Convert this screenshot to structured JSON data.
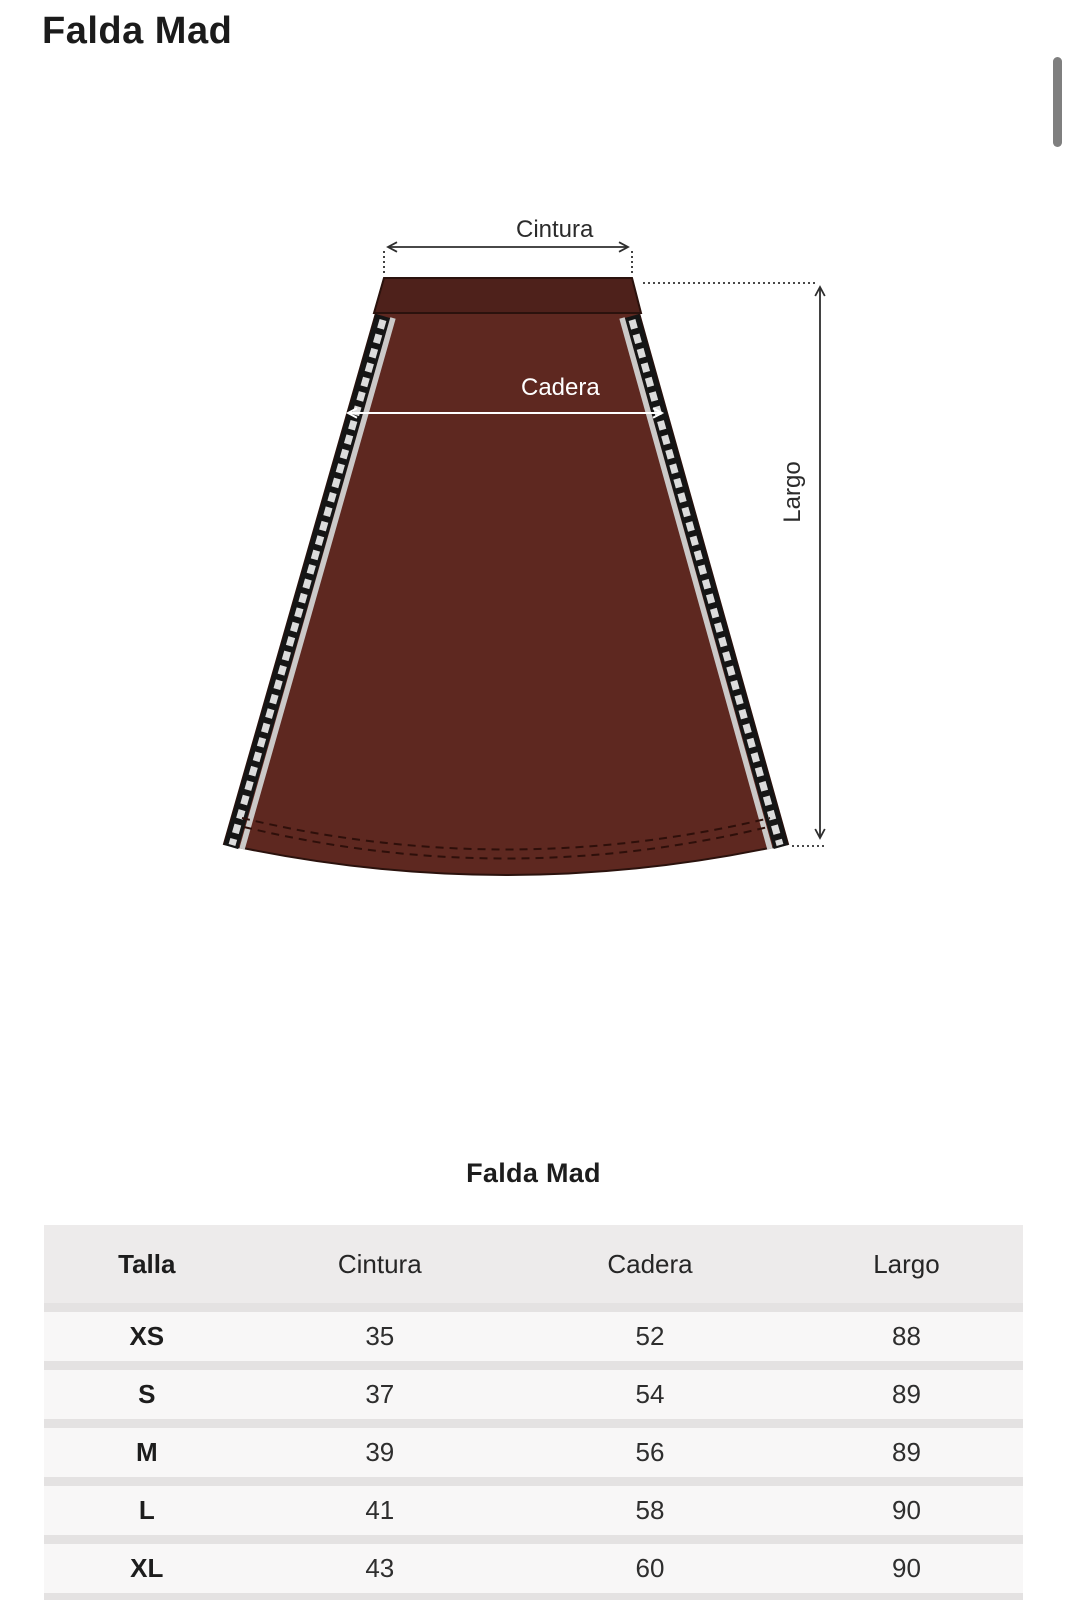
{
  "page": {
    "title": "Falda Mad",
    "background": "#ffffff"
  },
  "scrollbar": {
    "color": "#7f7f7f"
  },
  "diagram": {
    "waist_label": "Cintura",
    "hip_label": "Cadera",
    "length_label": "Largo",
    "colors": {
      "skirt_body": "#5e2820",
      "waistband": "#4e211b",
      "outline": "#2b120d",
      "side_tape": "#151515",
      "tape_stripe": "#cbc9c8",
      "stitch": "#2e0f0a",
      "measure_line": "#2e2e2e",
      "hip_measure_line": "#ffffff"
    }
  },
  "size_table": {
    "title": "Falda Mad",
    "columns": [
      "Talla",
      "Cintura",
      "Cadera",
      "Largo"
    ],
    "rows": [
      [
        "XS",
        "35",
        "52",
        "88"
      ],
      [
        "S",
        "37",
        "54",
        "89"
      ],
      [
        "M",
        "39",
        "56",
        "89"
      ],
      [
        "L",
        "41",
        "58",
        "90"
      ],
      [
        "XL",
        "43",
        "60",
        "90"
      ]
    ]
  }
}
